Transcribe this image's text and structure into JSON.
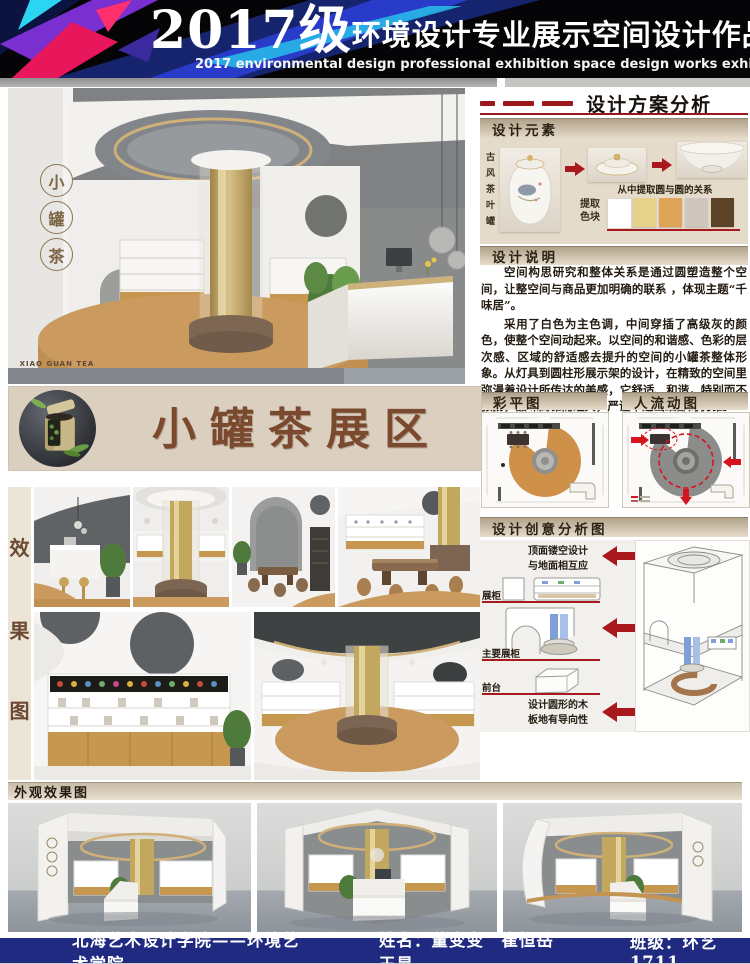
{
  "header": {
    "class_prefix": "2017级",
    "title_cn": "环境设计专业展示空间设计作品展",
    "title_en": "2017 environmental design professional exhibition space design works exhibition"
  },
  "logo": {
    "char_1": "小",
    "char_2": "罐",
    "char_3": "茶",
    "en": "XIAO GUAN TEA"
  },
  "banner": {
    "title": "小罐茶展区"
  },
  "analysis": {
    "title": "设计方案分析",
    "elements": {
      "header": "设计元素",
      "source_label": "古风茶叶罐",
      "relation_caption": "从中提取圆与圆的关系",
      "palette_label_line1": "提取",
      "palette_label_line2": "色块",
      "palette": [
        "#ffffff",
        "#e7d28b",
        "#dfa457",
        "#cfc7bf",
        "#5a4326"
      ]
    },
    "description": {
      "header": "设计说明",
      "para_1": "空间构思研究和整体关系是通过圆塑造整个空间，让整空间与商品更加明确的联系 ，体现主题“千味居”。",
      "para_2": "采用了白色为主色调，中间穿插了高级灰的颜色，使整个空间动起来。以空间的和谐感、色彩的层次感、区域的舒适感去提升的空间的小罐茶整体形象。从灯具到圆柱形展示架的设计，在精致的空间里弥漫着设计所传达的美感，它舒适、和谐，特别而不张扬，品味高雅而经典，严谨中透出细部的优雅。"
    },
    "plans": {
      "color_plan_header": "彩平图",
      "flow_plan_header": "人流动图"
    },
    "creative": {
      "header": "设计创意分析图",
      "note_top_line1": "顶面镂空设计",
      "note_top_line2": "与地面相互应",
      "label_display_cabinet": "展柜",
      "label_main_cabinet": "主要展柜",
      "label_front_desk": "前台",
      "note_bottom_line1": "设计圆形的木",
      "note_bottom_line2": "板地有导向性"
    }
  },
  "effects": {
    "char_1": "效",
    "char_2": "果",
    "char_3": "图"
  },
  "exterior": {
    "header": "外观效果图"
  },
  "footer": {
    "school": "北海艺术设计学院——环境艺术学院",
    "name_label": "姓名：",
    "names": "董变变　崔恒岳　王昊",
    "class_label": "班级：",
    "class_value": "环艺1711"
  },
  "colors": {
    "accent_red": "#9c171c",
    "footer_navy": "#1f2a80",
    "banner_brown": "#7b4a2e",
    "wood": "#c9995c",
    "gold": "#c2a465"
  }
}
